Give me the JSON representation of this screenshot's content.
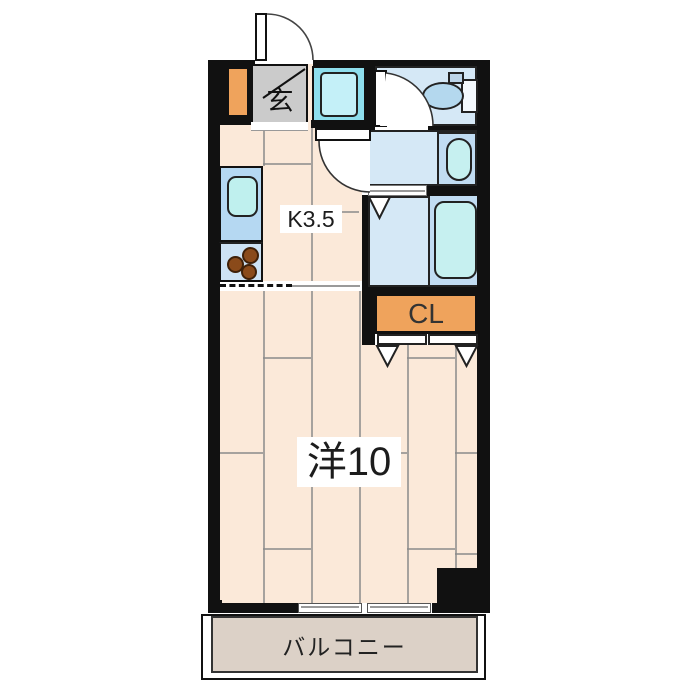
{
  "title": "apartment-floor-plan",
  "labels": {
    "entrance": "玄",
    "kitchen": "K3.5",
    "closet": "CL",
    "main_room": "洋10",
    "balcony": "バルコニー"
  },
  "colors": {
    "wall": "#111111",
    "floor": "#fbe9d9",
    "floor_line": "#8a8a8a",
    "room_blue": "#d5e8f6",
    "panel_blue": "#c1dcf2",
    "counter_blue": "#b5d8f2",
    "counter_lower_blue": "#cde2f4",
    "fixture_cyan": "#c6f0f0",
    "sink_cyan": "#bff0ee",
    "washer_cyan": "#8edeed",
    "washer_inner_cyan": "#c4f0f8",
    "toilet_blue": "#b4d8ee",
    "accent_orange": "#efa35c",
    "genkan_gray": "#cbcbcb",
    "balcony_gray": "#dcd1c7",
    "stove_brown": "#8a4a1a",
    "text": "#1c1c1c",
    "closet_text": "#333333"
  }
}
